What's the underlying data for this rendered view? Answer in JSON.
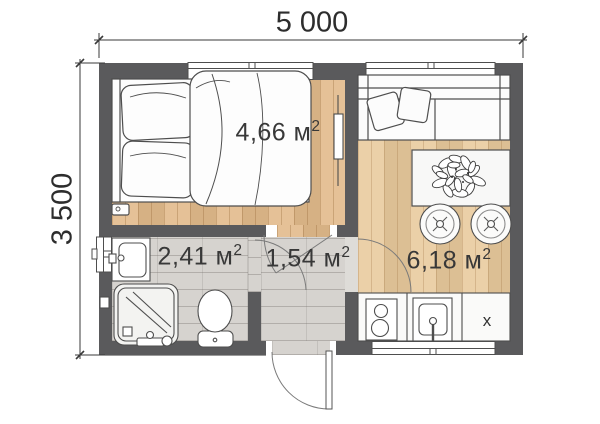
{
  "dimensions": {
    "width_label": "5 000",
    "height_label": "3 500"
  },
  "rooms": [
    {
      "name": "bedroom",
      "label": "4,66 м",
      "sup": "2"
    },
    {
      "name": "bathroom",
      "label": "2,41 м",
      "sup": "2"
    },
    {
      "name": "hallway",
      "label": "1,54 м",
      "sup": "2"
    },
    {
      "name": "living-kitchen",
      "label": "6,18 м",
      "sup": "2"
    }
  ],
  "kitchen": {
    "cabinet_label": "х"
  },
  "fixtures": [
    "bed",
    "sofa",
    "dining-table",
    "plant",
    "stool",
    "stove",
    "kitchen-sink",
    "bathroom-sink",
    "shower",
    "toilet",
    "radiator",
    "entrance-door"
  ],
  "colors": {
    "wall": "#5a5a5c",
    "wood_bedroom": "#e2ba8b",
    "wood_living": "#e8c99c",
    "tile": "#d6d3cf",
    "outline": "#4e4e4e",
    "dimension_text": "#2d2d2d"
  }
}
